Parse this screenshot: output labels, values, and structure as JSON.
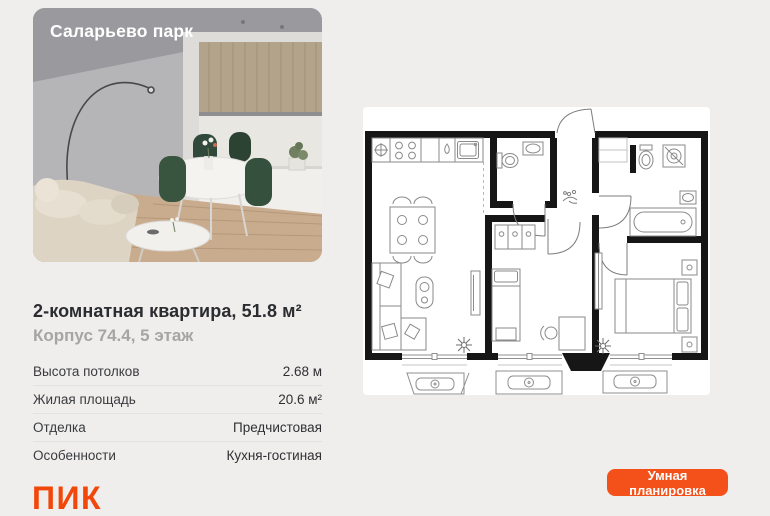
{
  "page": {
    "background": "#efeeec"
  },
  "photo": {
    "project_title": "Саларьево парк"
  },
  "listing": {
    "title": "2-комнатная квартира, 51.8 м²",
    "subtitle": "Корпус 74.4, 5 этаж",
    "specs": [
      {
        "label": "Высота потолков",
        "value": "2.68 м"
      },
      {
        "label": "Жилая площадь",
        "value": "20.6 м²"
      },
      {
        "label": "Отделка",
        "value": "Предчистовая"
      },
      {
        "label": "Особенности",
        "value": "Кухня-гостиная"
      }
    ]
  },
  "brand": {
    "name": "ПИК",
    "color": "#F2470B"
  },
  "floorplan": {
    "alt": "Планировка 2-комнатной квартиры",
    "fixtures": [
      "cooktop-icon",
      "kitchen-sink-icon",
      "vent-icon",
      "dining-table-icon",
      "sofa-icon",
      "tv-icon",
      "toilet-icon",
      "washbasin-icon",
      "washing-machine-icon",
      "bathtub-icon",
      "bed-icon",
      "double-bed-icon",
      "wardrobe-icon",
      "desk-icon",
      "plant-icon",
      "ac-unit-icon",
      "door-arc",
      "window"
    ]
  },
  "cta": {
    "label": "Умная планировка",
    "background": "#F4511A",
    "text_color": "#FFFFFF"
  }
}
